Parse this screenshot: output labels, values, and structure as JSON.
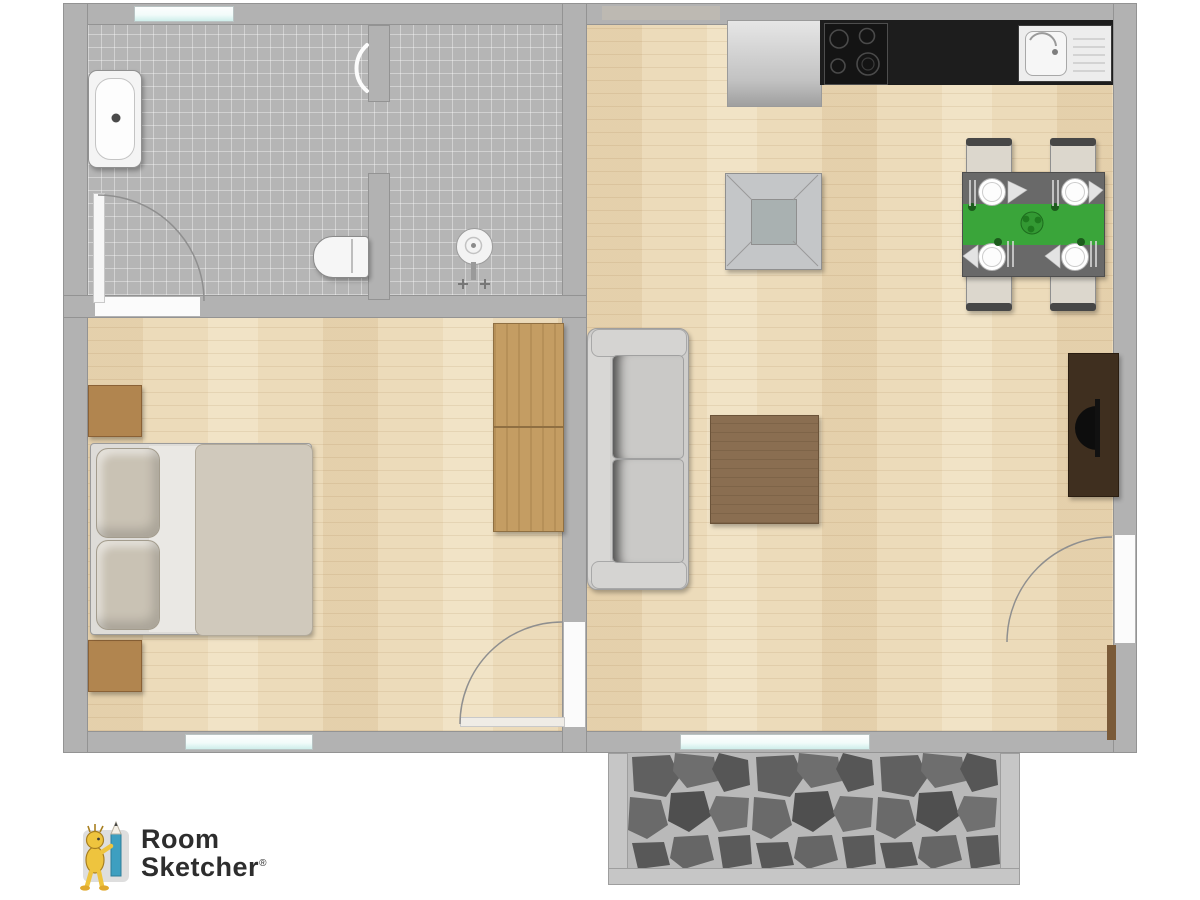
{
  "branding": {
    "line1": "Room",
    "line2": "Sketcher",
    "registered": "®"
  },
  "palette": {
    "wall": "#b2b2b2",
    "tile": "#b5b5b5",
    "wood": "#ecdbba",
    "glass_teal": "#c9ece8",
    "counter": "#1d1d1d",
    "appliance": "#cfcfcf",
    "sink_white": "#ededed",
    "table_gray": "#696969",
    "runner_green": "#3aa53a",
    "chair_seat": "#dcd7cd",
    "chair_back": "#474747",
    "duvet": "#d0c9bc",
    "sheet": "#eae8e4",
    "pillow": "#c9c2b4",
    "nightstand": "#b1854f",
    "wardrobe": "#c49d63",
    "sofa": "#cecdcb",
    "coffee_table": "#8a6e51",
    "tv_cabinet": "#3f2f1f",
    "door_leaf_brown": "#7a5a38",
    "arc_stroke": "#8f8f8f",
    "stone": "#616161",
    "grout": "#b9b9b9",
    "logo_text": "#2d2d2d",
    "mascot_yellow": "#eec43e",
    "pencil_blue": "#3e9fc0"
  },
  "icons": {
    "bathtub": "rounded white tub with faucet dot",
    "toilet": "bowl with tank against wall",
    "pedestal-sink": "round basin with taps",
    "cooktop": "four burner rings on black counter",
    "kitchen-sink": "basin with drainer lines",
    "dining-set": "table with green runner, four plates, four chairs",
    "double-bed": "two pillows, sheet and duvet",
    "wardrobe": "wooden two-door closet",
    "sofa": "two-seat couch against wall",
    "tv": "flat screen on dark sideboard",
    "door-swing": "quarter-circle arc",
    "patio": "grey flagstone terrace"
  }
}
